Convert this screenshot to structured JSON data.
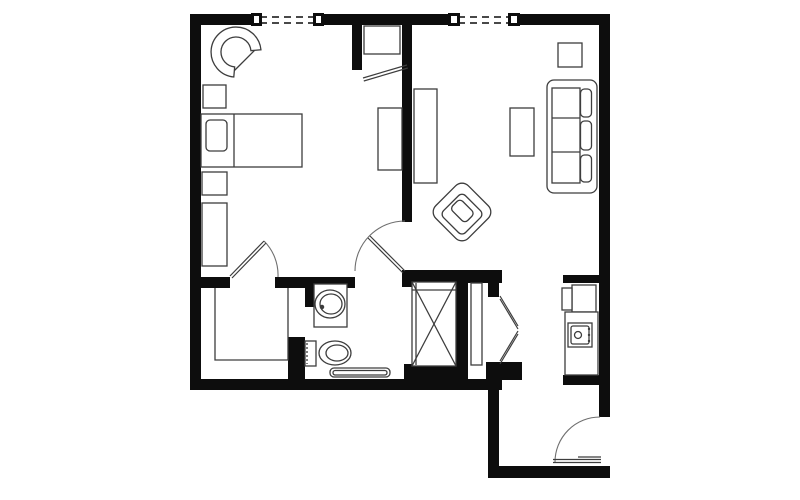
{
  "figure": {
    "kind": "architectural floor plan",
    "description": "black-and-white floor plan of a one-bedroom apartment unit"
  },
  "colors": {
    "background": "#ffffff",
    "wall": "#0d0d0d",
    "furniture_line": "#3d3d3d",
    "door_line": "#6f6f6f",
    "white": "#ffffff"
  },
  "rooms_depicted": [
    "bedroom",
    "living-room",
    "bathroom",
    "walk-in-closet",
    "kitchenette",
    "entry-hall"
  ],
  "windows": [
    "bedroom-window",
    "living-room-window"
  ],
  "doors": [
    "bedroom-closet-door",
    "hall-living-door",
    "wardrobe-door",
    "bifold-closet-doors",
    "entry-door"
  ],
  "fixtures": [
    "bathroom-sink",
    "toilet",
    "roll-in-shower",
    "bath-mat",
    "refrigerator",
    "stove",
    "kitchen-counter"
  ],
  "furniture": [
    "tub-chair",
    "nightstand",
    "bed-with-pillow",
    "nightstand",
    "dresser",
    "wardrobe-shelf",
    "dresser",
    "media-console",
    "coffee-table",
    "side-table",
    "sofa",
    "accent-chair",
    "closet-shelving",
    "linen-shelf"
  ]
}
